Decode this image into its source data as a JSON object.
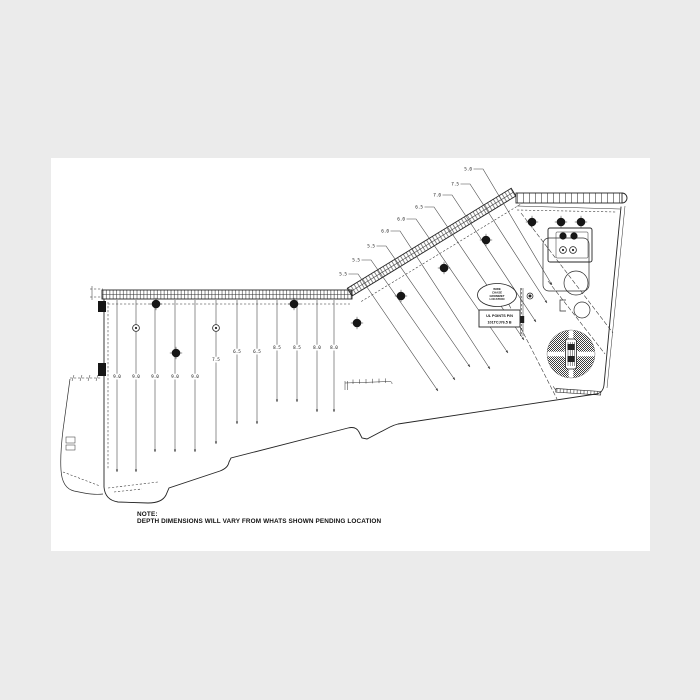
{
  "colors": {
    "canvas": "#ebebeb",
    "paper": "#ffffff",
    "ink": "#242424",
    "dim_line": "#474747"
  },
  "note": {
    "label": "NOTE:",
    "text": "DEPTH DIMENSIONS WILL VARY FROM WHATS SHOWN PENDING LOCATION"
  },
  "badges": {
    "oval": {
      "lines": [
        "WIRE",
        "CHASE",
        "GROMMET",
        "LOCATION"
      ]
    },
    "rect": {
      "lines": [
        "UL POINTS P/N",
        "101TCJ76.5 B"
      ]
    }
  },
  "dimensions": {
    "left": [
      {
        "x": 117,
        "y1": 300,
        "y2": 472,
        "label": "9.0",
        "label_y": 378
      },
      {
        "x": 136,
        "y1": 300,
        "y2": 472,
        "label": "9.0",
        "label_y": 378
      },
      {
        "x": 155,
        "y1": 300,
        "y2": 452,
        "label": "9.0",
        "label_y": 378
      },
      {
        "x": 175,
        "y1": 300,
        "y2": 452,
        "label": "9.0",
        "label_y": 378
      },
      {
        "x": 195,
        "y1": 300,
        "y2": 452,
        "label": "9.0",
        "label_y": 378
      },
      {
        "x": 216,
        "y1": 300,
        "y2": 444,
        "label": "7.5",
        "label_y": 361
      },
      {
        "x": 237,
        "y1": 300,
        "y2": 424,
        "label": "6.5",
        "label_y": 353
      },
      {
        "x": 257,
        "y1": 300,
        "y2": 424,
        "label": "6.5",
        "label_y": 353
      },
      {
        "x": 277,
        "y1": 300,
        "y2": 402,
        "label": "8.5",
        "label_y": 349
      },
      {
        "x": 297,
        "y1": 300,
        "y2": 402,
        "label": "8.5",
        "label_y": 349
      },
      {
        "x": 317,
        "y1": 300,
        "y2": 412,
        "label": "8.0",
        "label_y": 349
      },
      {
        "x": 334,
        "y1": 300,
        "y2": 412,
        "label": "8.0",
        "label_y": 349
      }
    ],
    "slant": [
      {
        "label": "5.5",
        "lx": 347,
        "ly": 274,
        "ax": 438,
        "ay": 391
      },
      {
        "label": "5.5",
        "lx": 360,
        "ly": 260,
        "ax": 455,
        "ay": 380
      },
      {
        "label": "5.5",
        "lx": 375,
        "ly": 246,
        "ax": 470,
        "ay": 367
      },
      {
        "label": "6.0",
        "lx": 389,
        "ly": 231,
        "ax": 490,
        "ay": 369
      },
      {
        "label": "6.0",
        "lx": 405,
        "ly": 219,
        "ax": 508,
        "ay": 353
      },
      {
        "label": "6.5",
        "lx": 423,
        "ly": 207,
        "ax": 524,
        "ay": 340
      },
      {
        "label": "7.0",
        "lx": 441,
        "ly": 195,
        "ax": 536,
        "ay": 322
      },
      {
        "label": "7.5",
        "lx": 459,
        "ly": 184,
        "ax": 547,
        "ay": 303
      },
      {
        "label": "5.0",
        "lx": 472,
        "ly": 169,
        "ax": 552,
        "ay": 285
      }
    ]
  },
  "symbols": {
    "bolts": [
      [
        156,
        304
      ],
      [
        176,
        353
      ],
      [
        294,
        304
      ],
      [
        357,
        323
      ],
      [
        401,
        296
      ],
      [
        444,
        268
      ],
      [
        486,
        240
      ],
      [
        532,
        222
      ],
      [
        561,
        222
      ],
      [
        581,
        222
      ]
    ],
    "plugs": [
      [
        563,
        236
      ],
      [
        574,
        236
      ]
    ],
    "eyelets": [
      [
        136,
        328
      ],
      [
        216,
        328
      ],
      [
        563,
        250
      ],
      [
        573,
        250
      ]
    ],
    "datum": [
      530,
      296
    ]
  }
}
